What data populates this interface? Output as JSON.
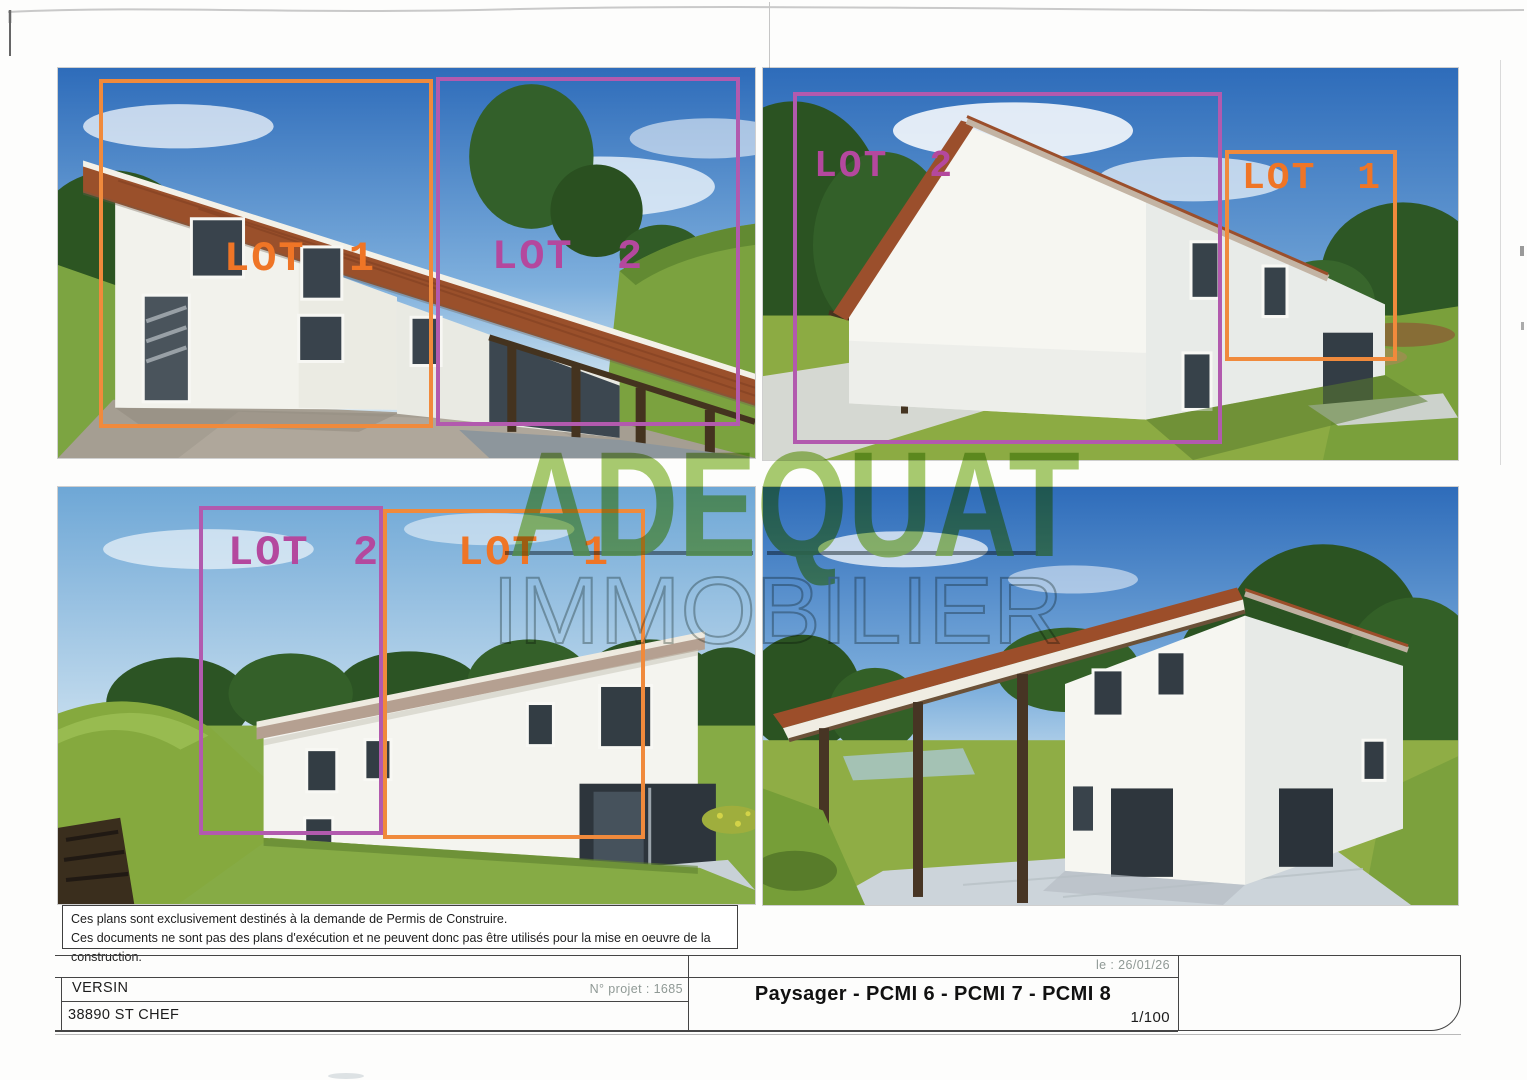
{
  "document": {
    "disclaimer": {
      "line1": "Ces plans sont exclusivement destinés à la demande de Permis de Construire.",
      "line2": "Ces documents ne sont pas des plans d'exécution et ne peuvent donc pas être utilisés pour la mise en oeuvre de la construction."
    },
    "watermark": {
      "primary": "ADEQUAT",
      "secondary": "IMMOBILIER",
      "primary_color": "#9cc45c",
      "secondary_color": "#a9b1ad"
    },
    "title_block": {
      "client": "VERSIN",
      "location": "38890 ST CHEF",
      "project_number": "N° projet : 1685",
      "date": "le : 26/01/26",
      "drawing_title": "Paysager - PCMI 6 - PCMI 7 - PCMI 8",
      "scale": "1/100"
    },
    "photos": {
      "top_left": {
        "boxes": [
          {
            "lot": "LOT 1",
            "color": "#ef7d2e"
          },
          {
            "lot": "LOT 2",
            "color": "#b4489e"
          }
        ]
      },
      "top_right": {
        "boxes": [
          {
            "lot": "LOT 2",
            "color": "#b4489e"
          },
          {
            "lot": "LOT 1",
            "color": "#ef7d2e"
          }
        ]
      },
      "bottom_left": {
        "boxes": [
          {
            "lot": "LOT 2",
            "color": "#b4489e"
          },
          {
            "lot": "LOT 1",
            "color": "#ef7d2e"
          }
        ]
      },
      "bottom_right": {
        "boxes": []
      }
    },
    "colors": {
      "lot1_orange": "#ef7d2e",
      "lot2_purple": "#b25aae"
    }
  }
}
